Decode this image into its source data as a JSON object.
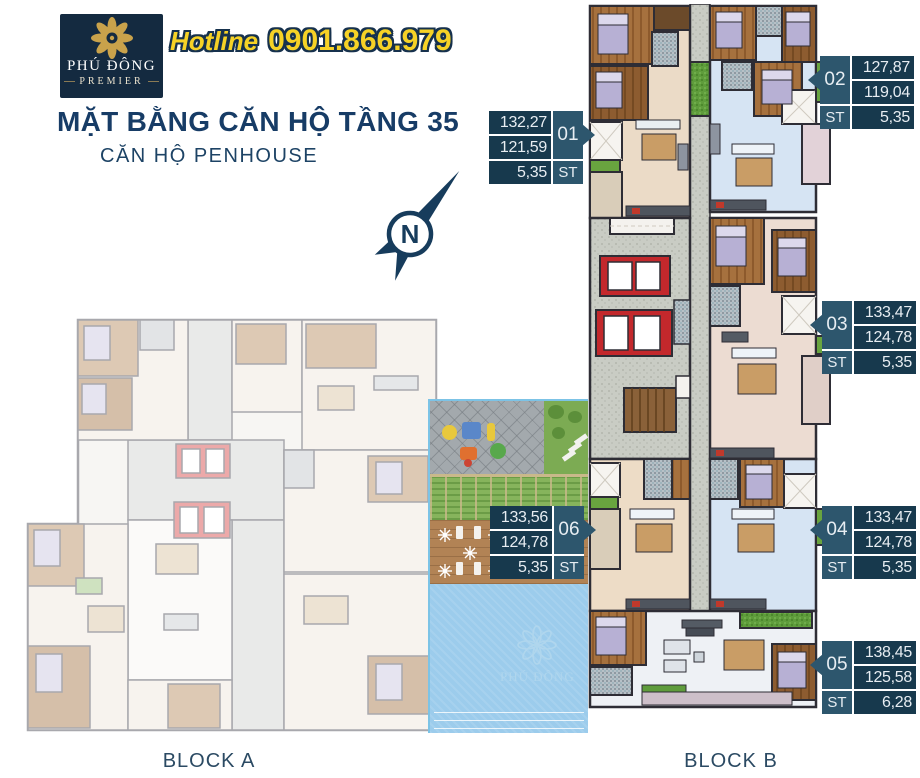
{
  "header": {
    "logo": {
      "brand_name": "PHÚ ĐÔNG",
      "brand_sub": "PREMIER"
    },
    "hotline": {
      "label": "Hotline",
      "number": "0901.866.979"
    },
    "title": "MẶT BẰNG CĂN HỘ TẦNG 35",
    "subtitle": "CĂN HỘ PENHOUSE"
  },
  "compass": {
    "north_letter": "N"
  },
  "apartments": [
    {
      "unit": "01",
      "gross_area": "132,27",
      "net_area": "121,59",
      "st_area": "5,35",
      "st_label": "ST"
    },
    {
      "unit": "02",
      "gross_area": "127,87",
      "net_area": "119,04",
      "st_area": "5,35",
      "st_label": "ST"
    },
    {
      "unit": "03",
      "gross_area": "133,47",
      "net_area": "124,78",
      "st_area": "5,35",
      "st_label": "ST"
    },
    {
      "unit": "04",
      "gross_area": "133,47",
      "net_area": "124,78",
      "st_area": "5,35",
      "st_label": "ST"
    },
    {
      "unit": "05",
      "gross_area": "138,45",
      "net_area": "125,58",
      "st_area": "6,28",
      "st_label": "ST"
    },
    {
      "unit": "06",
      "gross_area": "133,56",
      "net_area": "124,78",
      "st_area": "5,35",
      "st_label": "ST"
    }
  ],
  "blocks": {
    "block_a": "BLOCK A",
    "block_b": "BLOCK B"
  },
  "pool": {
    "watermark_text": "PHÚ ĐÔNG"
  },
  "colors": {
    "label_value_bg": "#17394d",
    "label_number_bg": "#2d566d",
    "title_navy": "#173c66",
    "hotline_yellow": "#f6d226",
    "logo_bg": "#142a40",
    "gold": "#c9a24b",
    "elevator_red": "#c3282c",
    "balcony_green": "#69a43f",
    "pool_blue": "#9cccec"
  }
}
